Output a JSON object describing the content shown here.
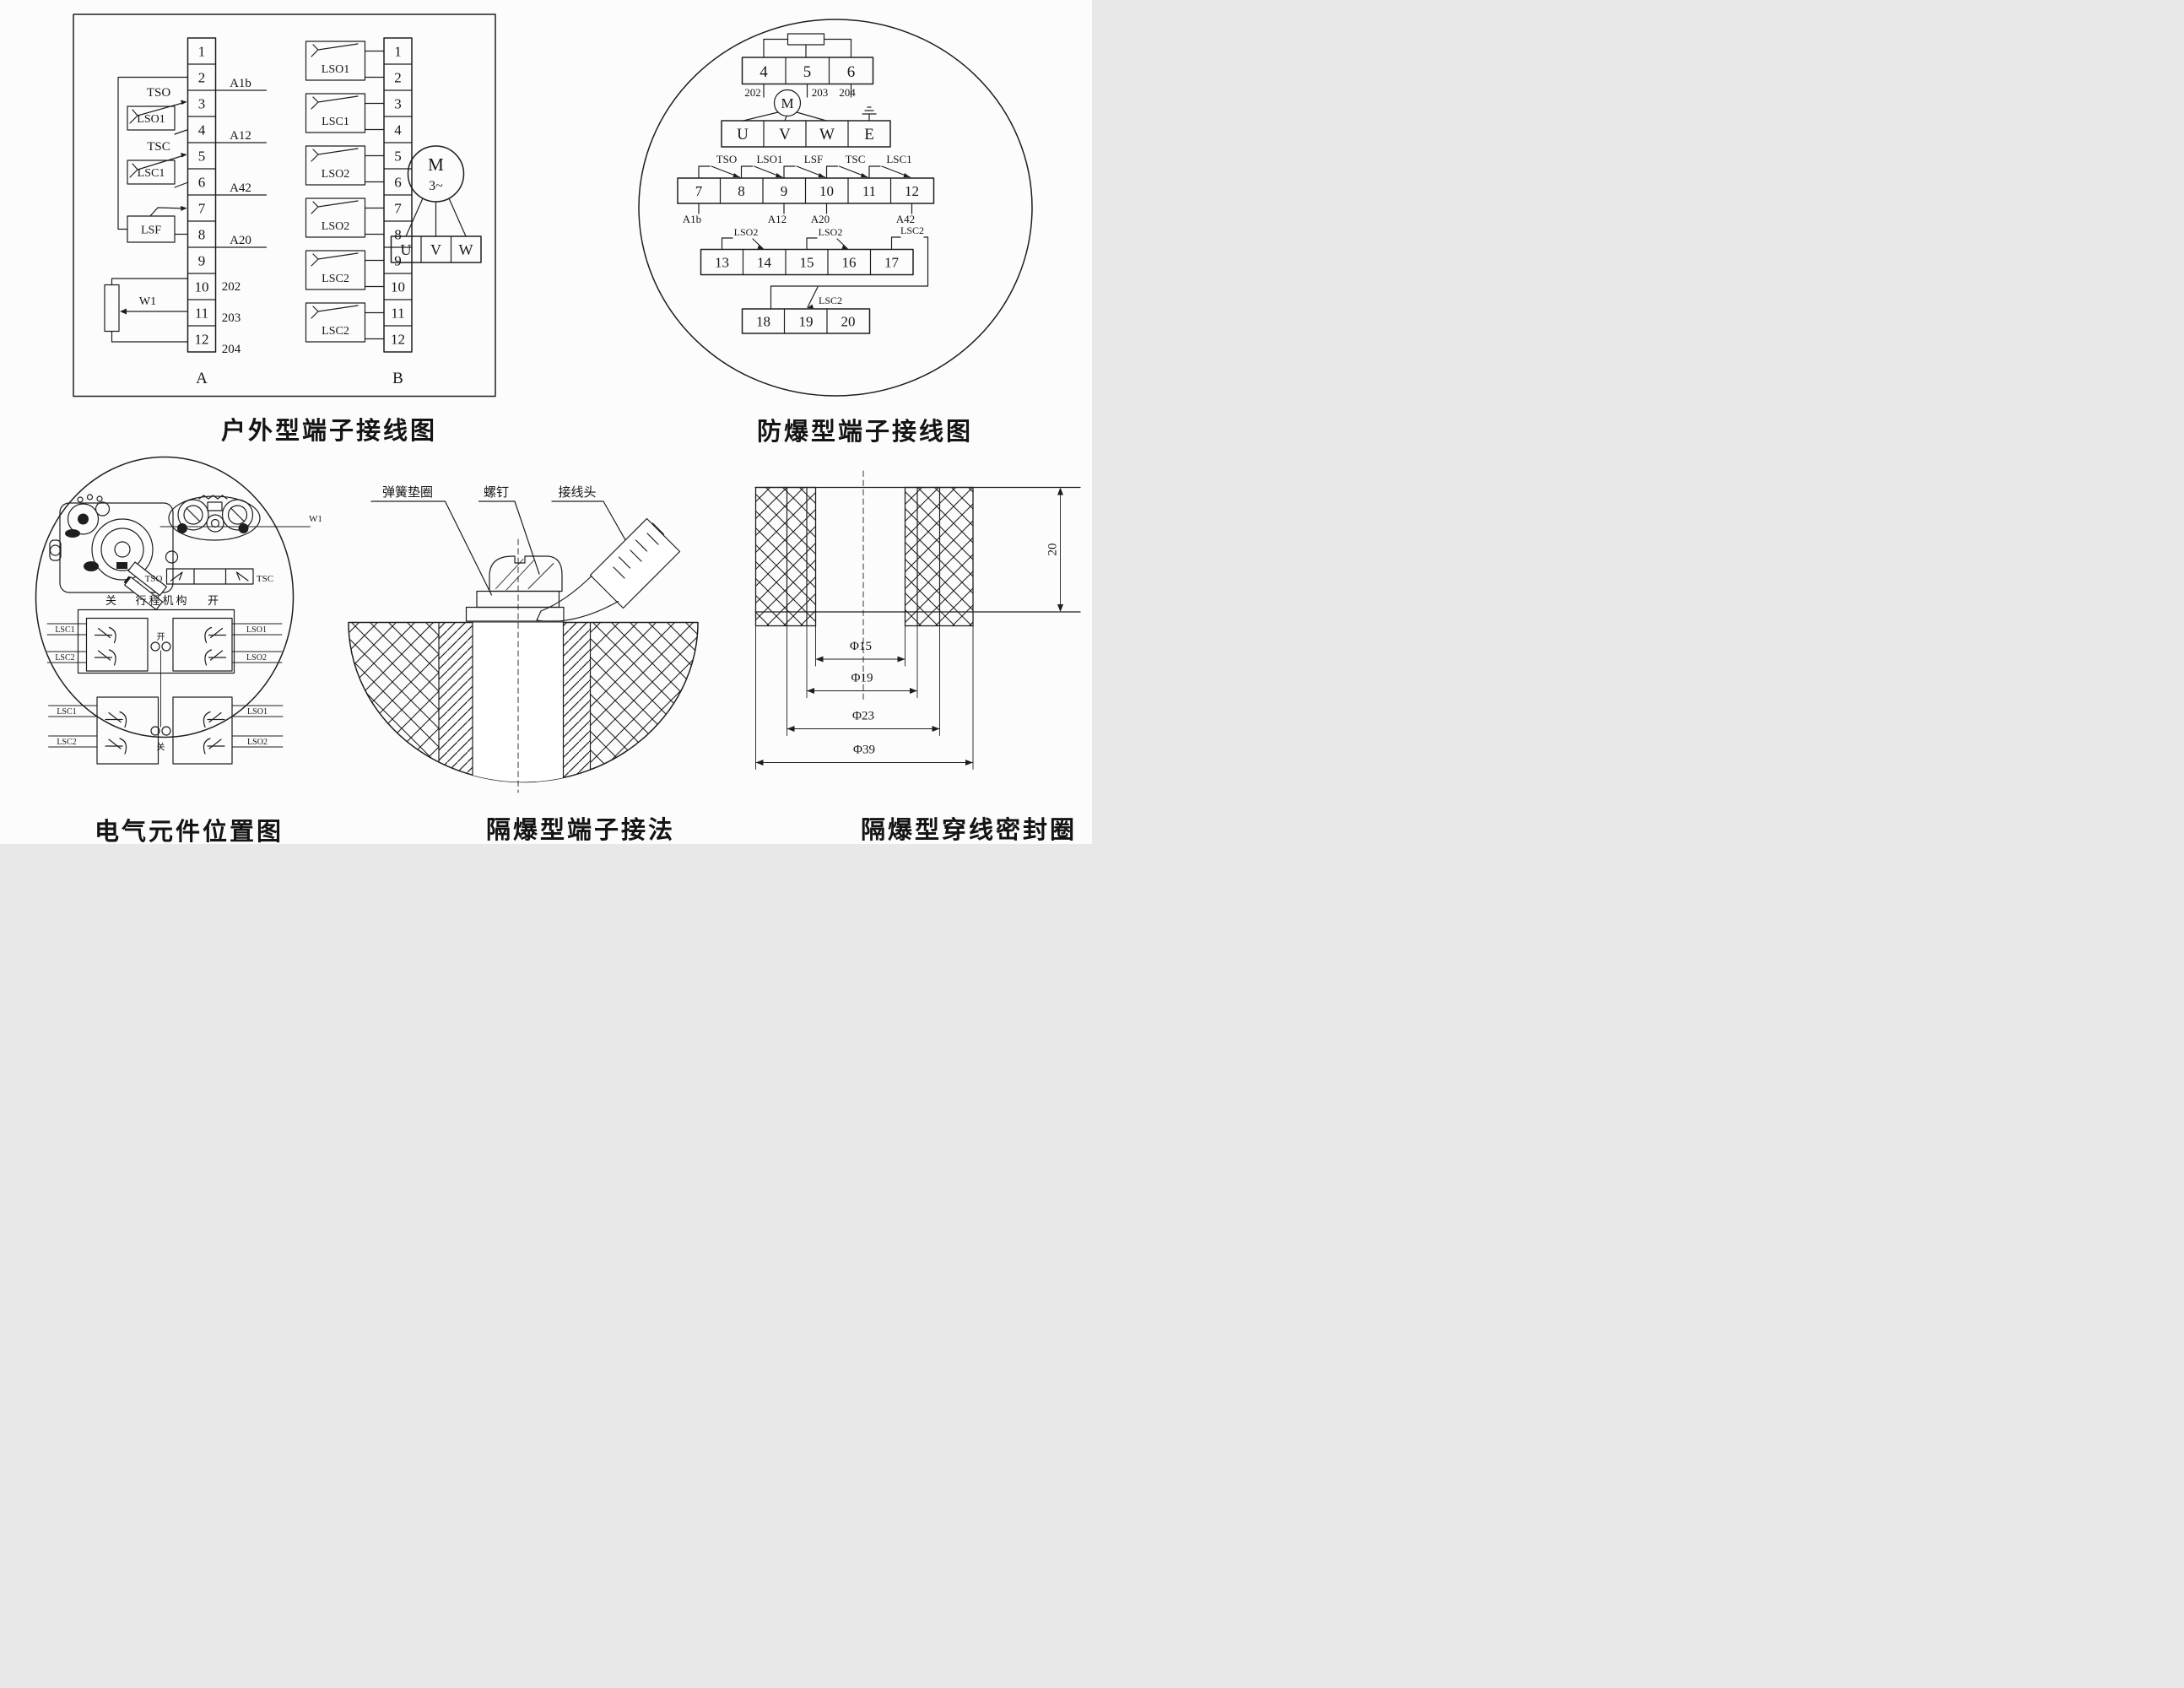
{
  "fig1": {
    "caption": "户外型端子接线图",
    "strip_a_label": "A",
    "strip_b_label": "B",
    "a_cells": [
      "1",
      "2",
      "3",
      "4",
      "5",
      "6",
      "7",
      "8",
      "9",
      "10",
      "11",
      "12"
    ],
    "b_cells": [
      "1",
      "2",
      "3",
      "4",
      "5",
      "6",
      "7",
      "8",
      "9",
      "10",
      "11",
      "12"
    ],
    "wire_labels": [
      "A1b",
      "A12",
      "A42",
      "A20"
    ],
    "w_labels": [
      "202",
      "203",
      "204"
    ],
    "tso": "TSO",
    "lso1": "LSO1",
    "tsc": "TSC",
    "lsc1": "LSC1",
    "lsf": "LSF",
    "w1": "W1",
    "b_boxes": [
      "LSO1",
      "LSC1",
      "LSO2",
      "LSO2",
      "LSC2",
      "LSC2"
    ],
    "motor_m": "M",
    "motor_ph": "3~",
    "u": "U",
    "v": "V",
    "w": "W"
  },
  "fig2": {
    "caption": "防爆型端子接线图",
    "row1": [
      "4",
      "5",
      "6"
    ],
    "row1_wires": [
      "202",
      "203",
      "204"
    ],
    "motor": "M",
    "uvwe": [
      "U",
      "V",
      "W",
      "E"
    ],
    "row2": [
      "7",
      "8",
      "9",
      "10",
      "11",
      "12"
    ],
    "row2_sw": [
      "TSO",
      "LSO1",
      "LSF",
      "TSC",
      "LSC1"
    ],
    "row2_wires": [
      "A1b",
      "A12",
      "A20",
      "A42"
    ],
    "row3": [
      "13",
      "14",
      "15",
      "16",
      "17"
    ],
    "row3_sw": [
      "LSO2",
      "LSO2",
      "LSC2"
    ],
    "row4": [
      "18",
      "19",
      "20"
    ],
    "row4_sw": "LSC2"
  },
  "fig3": {
    "caption": "电气元件位置图",
    "tso": "TSO",
    "tsc": "TSC",
    "w1": "W1",
    "mech_left": "关",
    "mech": "行程机构",
    "mech_right": "开",
    "open_char": "开",
    "close_char": "关",
    "left_labels": [
      "LSC1",
      "LSC2",
      "LSC1",
      "LSC2"
    ],
    "right_labels": [
      "LSO1",
      "LSO2",
      "LSO1",
      "LSO2"
    ]
  },
  "fig4": {
    "caption": "隔爆型端子接法",
    "spring_washer": "弹簧垫圈",
    "screw": "螺钉",
    "lug": "接线头"
  },
  "fig5": {
    "caption": "隔爆型穿线密封圈",
    "d15": "Φ15",
    "d19": "Φ19",
    "d23": "Φ23",
    "d39": "Φ39",
    "h20": "20"
  }
}
